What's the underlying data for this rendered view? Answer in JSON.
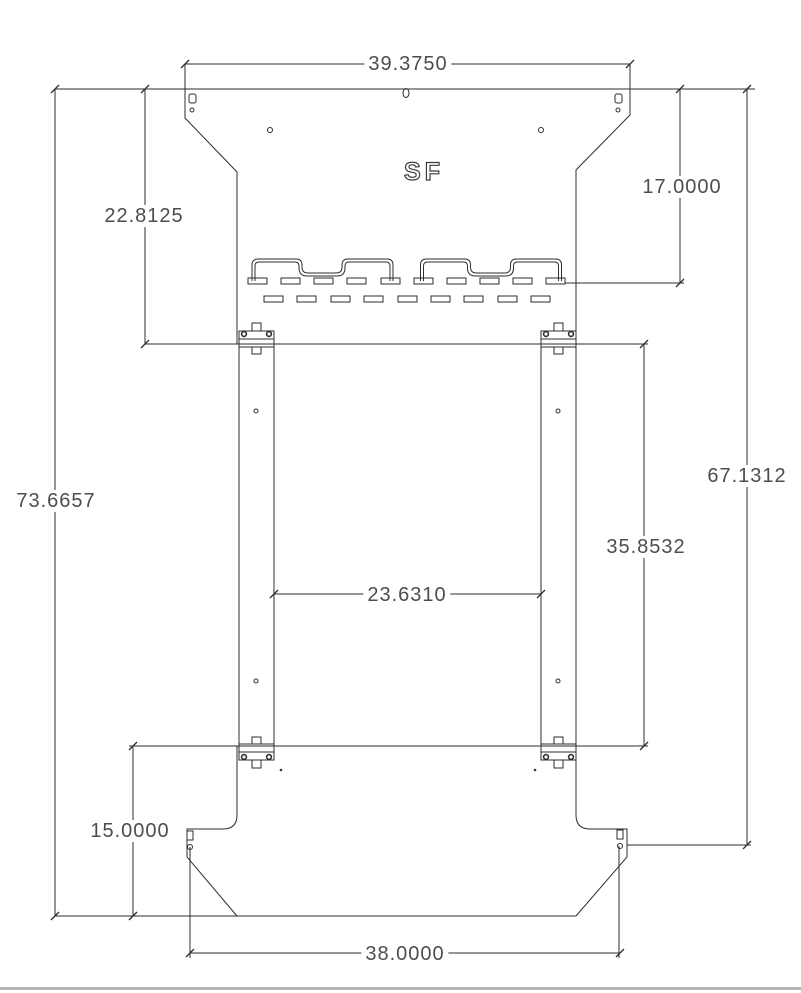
{
  "drawing": {
    "logo": "SF",
    "dimensions": {
      "top_width": "39.3750",
      "upper_plate_height": "22.8125",
      "slot_row_offset": "17.0000",
      "overall_height": "73.6657",
      "side_hole_height": "67.1312",
      "rail_length": "35.8532",
      "rail_inner_gap": "23.6310",
      "lower_plate_height": "15.0000",
      "bottom_hole_span": "38.0000"
    },
    "colors": {
      "line": "#2e2e2e",
      "text": "#4d4d4d",
      "background": "#ffffff",
      "bottom_bar": "#b5b5b5"
    }
  }
}
